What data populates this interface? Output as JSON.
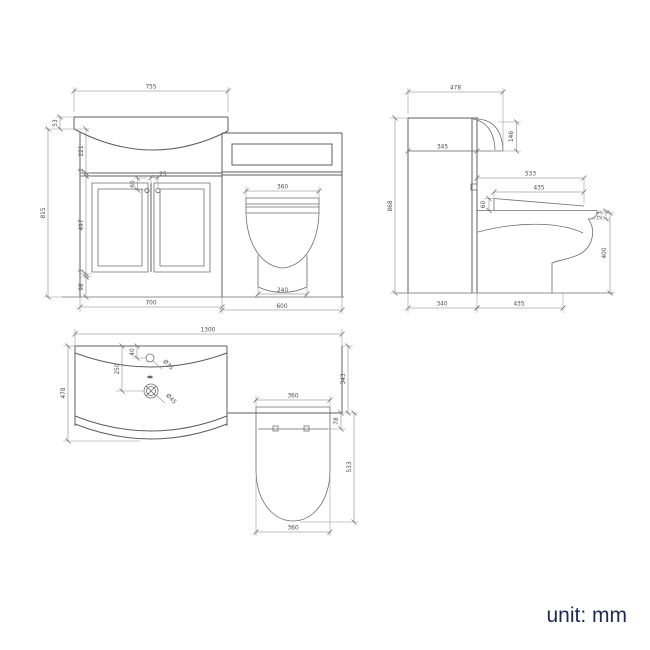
{
  "note": {
    "unit_label": "unit: mm"
  },
  "front_view": {
    "basin_width": "755",
    "rim_height": "53",
    "basin_height": "221",
    "worktop": "2",
    "unit_height": "815",
    "door_height": "497",
    "gap": "3",
    "plinth_height": "98",
    "handle_drop": "60",
    "handle_offset": "25",
    "seat_width": "360",
    "pedestal_width": "240",
    "vanity_width": "700",
    "wc_width": "600"
  },
  "side_view": {
    "depth": "478",
    "overall_height": "868",
    "internal_depth": "345",
    "basin_front_height": "146",
    "seat_reach": "533",
    "seat_depth": "435",
    "seat_rise": "60",
    "rim_drop": "23",
    "pan_height": "400",
    "unit_depth": "340",
    "pan_reach": "435"
  },
  "plan_view": {
    "overall_width": "1300",
    "depth": "478",
    "tap_setback": "40",
    "waste_setback": "250",
    "tap_hole": "Ø35",
    "waste_hole": "Ø45",
    "seat_width": "360",
    "unit_depth": "343",
    "hinge_offset": "78",
    "pan_projection": "533",
    "pan_width": "360"
  }
}
